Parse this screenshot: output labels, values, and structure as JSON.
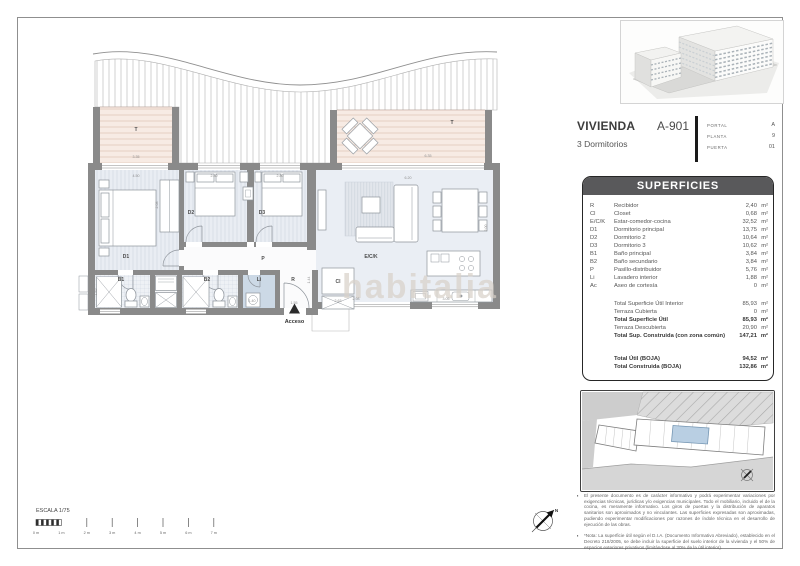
{
  "unit_card": {
    "title": "VIVIENDA",
    "code": "A-901",
    "subtitle": "3 Dormitorios",
    "details": [
      {
        "label": "PORTAL",
        "value": "A"
      },
      {
        "label": "PLANTA",
        "value": "9"
      },
      {
        "label": "PUERTA",
        "value": "01"
      }
    ]
  },
  "superficies": {
    "header": "SUPERFICIES",
    "unit": "m²",
    "rows": [
      {
        "code": "R",
        "name": "Recibidor",
        "value": "2,40"
      },
      {
        "code": "Cl",
        "name": "Closet",
        "value": "0,68"
      },
      {
        "code": "E/C/K",
        "name": "Estar-comedor-cocina",
        "value": "32,52"
      },
      {
        "code": "D1",
        "name": "Dormitorio principal",
        "value": "13,75"
      },
      {
        "code": "D2",
        "name": "Dormitorio 2",
        "value": "10,64"
      },
      {
        "code": "D3",
        "name": "Dormitorio 3",
        "value": "10,62"
      },
      {
        "code": "B1",
        "name": "Baño principal",
        "value": "3,84"
      },
      {
        "code": "B2",
        "name": "Baño secundario",
        "value": "3,84"
      },
      {
        "code": "P",
        "name": "Pasillo-distribuidor",
        "value": "5,76"
      },
      {
        "code": "Li",
        "name": "Lavadero interior",
        "value": "1,88"
      },
      {
        "code": "Ac",
        "name": "Aseo de cortesía",
        "value": "0"
      }
    ],
    "totals": [
      {
        "name": "Total Superficie Útil Interior",
        "value": "85,93",
        "bold": false
      },
      {
        "name": "Terraza Cubierta",
        "value": "0",
        "bold": false
      },
      {
        "name": "Total Superficie Útil",
        "value": "85,93",
        "bold": true
      },
      {
        "name": "Terraza Descubierta",
        "value": "20,90",
        "bold": false
      },
      {
        "name": "Total Sup. Construida (con zona común)",
        "value": "147,21",
        "bold": true
      }
    ],
    "boja": [
      {
        "name": "Total Útil (BOJA)",
        "value": "94,52"
      },
      {
        "name": "Total Construida (BOJA)",
        "value": "132,86"
      }
    ]
  },
  "plan": {
    "watermark": "habitalia",
    "access_label": "Acceso",
    "rooms": [
      {
        "id": "terrace-left",
        "label": "T",
        "x": 136,
        "y": 131
      },
      {
        "id": "terrace-right",
        "label": "T",
        "x": 452,
        "y": 124
      },
      {
        "id": "d1",
        "label": "D1",
        "x": 126,
        "y": 258
      },
      {
        "id": "d2",
        "label": "D2",
        "x": 191,
        "y": 214
      },
      {
        "id": "d3",
        "label": "D3",
        "x": 262,
        "y": 214
      },
      {
        "id": "pasillo",
        "label": "P",
        "x": 263,
        "y": 260
      },
      {
        "id": "eck",
        "label": "E/C/K",
        "x": 371,
        "y": 258
      },
      {
        "id": "b1",
        "label": "B1",
        "x": 121,
        "y": 281
      },
      {
        "id": "b2",
        "label": "B2",
        "x": 207,
        "y": 281
      },
      {
        "id": "li",
        "label": "Li",
        "x": 259,
        "y": 281
      },
      {
        "id": "recibidor",
        "label": "R",
        "x": 293,
        "y": 281
      },
      {
        "id": "closet",
        "label": "Cl",
        "x": 338,
        "y": 283
      }
    ],
    "dimensions": [
      {
        "t": "4.50",
        "x": 136,
        "y": 177
      },
      {
        "t": "2.80",
        "x": 214,
        "y": 177
      },
      {
        "t": "2.80",
        "x": 280,
        "y": 177
      },
      {
        "t": "6.20",
        "x": 408,
        "y": 179
      },
      {
        "t": "3.35",
        "x": 136,
        "y": 158
      },
      {
        "t": "6.35",
        "x": 428,
        "y": 157
      },
      {
        "t": "2.98",
        "x": 356,
        "y": 300
      },
      {
        "t": "3.05",
        "x": 446,
        "y": 300
      },
      {
        "t": "1.55",
        "x": 294,
        "y": 304
      },
      {
        "t": "2.63",
        "x": 338,
        "y": 302
      },
      {
        "t": "1.40",
        "x": 252,
        "y": 302
      },
      {
        "t": "2.08",
        "x": 158,
        "y": 205,
        "r": -90
      },
      {
        "t": "1.82",
        "x": 97,
        "y": 292,
        "r": -90
      },
      {
        "t": "2.00",
        "x": 487,
        "y": 228,
        "r": -90
      },
      {
        "t": "1.44",
        "x": 310,
        "y": 280,
        "r": -90
      }
    ]
  },
  "scalebar": {
    "label": "ESCALA 1/75",
    "ticks": [
      "0 m",
      "1 m",
      "2 m",
      "3 m",
      "4 m",
      "5 m",
      "6 m",
      "7 m"
    ]
  },
  "compass": {
    "label": "N"
  },
  "notes": [
    "El presente documento es de carácter informativo y podrá experimentar variaciones por exigencias técnicas, jurídicas y/o exigencias municipales. Todo el mobiliario, incluido el de la cocina, es meramente informativo. Los giros de puertas y la distribución de aparatos sanitarios son aproximados y no vinculantes. Las superficies expresadas son aproximadas, pudiendo experimentar modificaciones por razones de índole técnica en el desarrollo de ejecución de las obras.",
    "*Nota: La superficie útil según el D.I.A. (Documento Informativo Abreviado), establecido en el Decreto 218/2005, se debe incluir la superficie del suelo interior de la vivienda y el 50% de espacios exteriores privativos (limitándose al 30% de la útil interior)."
  ],
  "colors": {
    "wall": "#8a8a8a",
    "terrace": "#f7ebe4",
    "floor": "#e9edf3",
    "highlight_unit": "#b9cfe3",
    "header_bg": "#59595b"
  }
}
